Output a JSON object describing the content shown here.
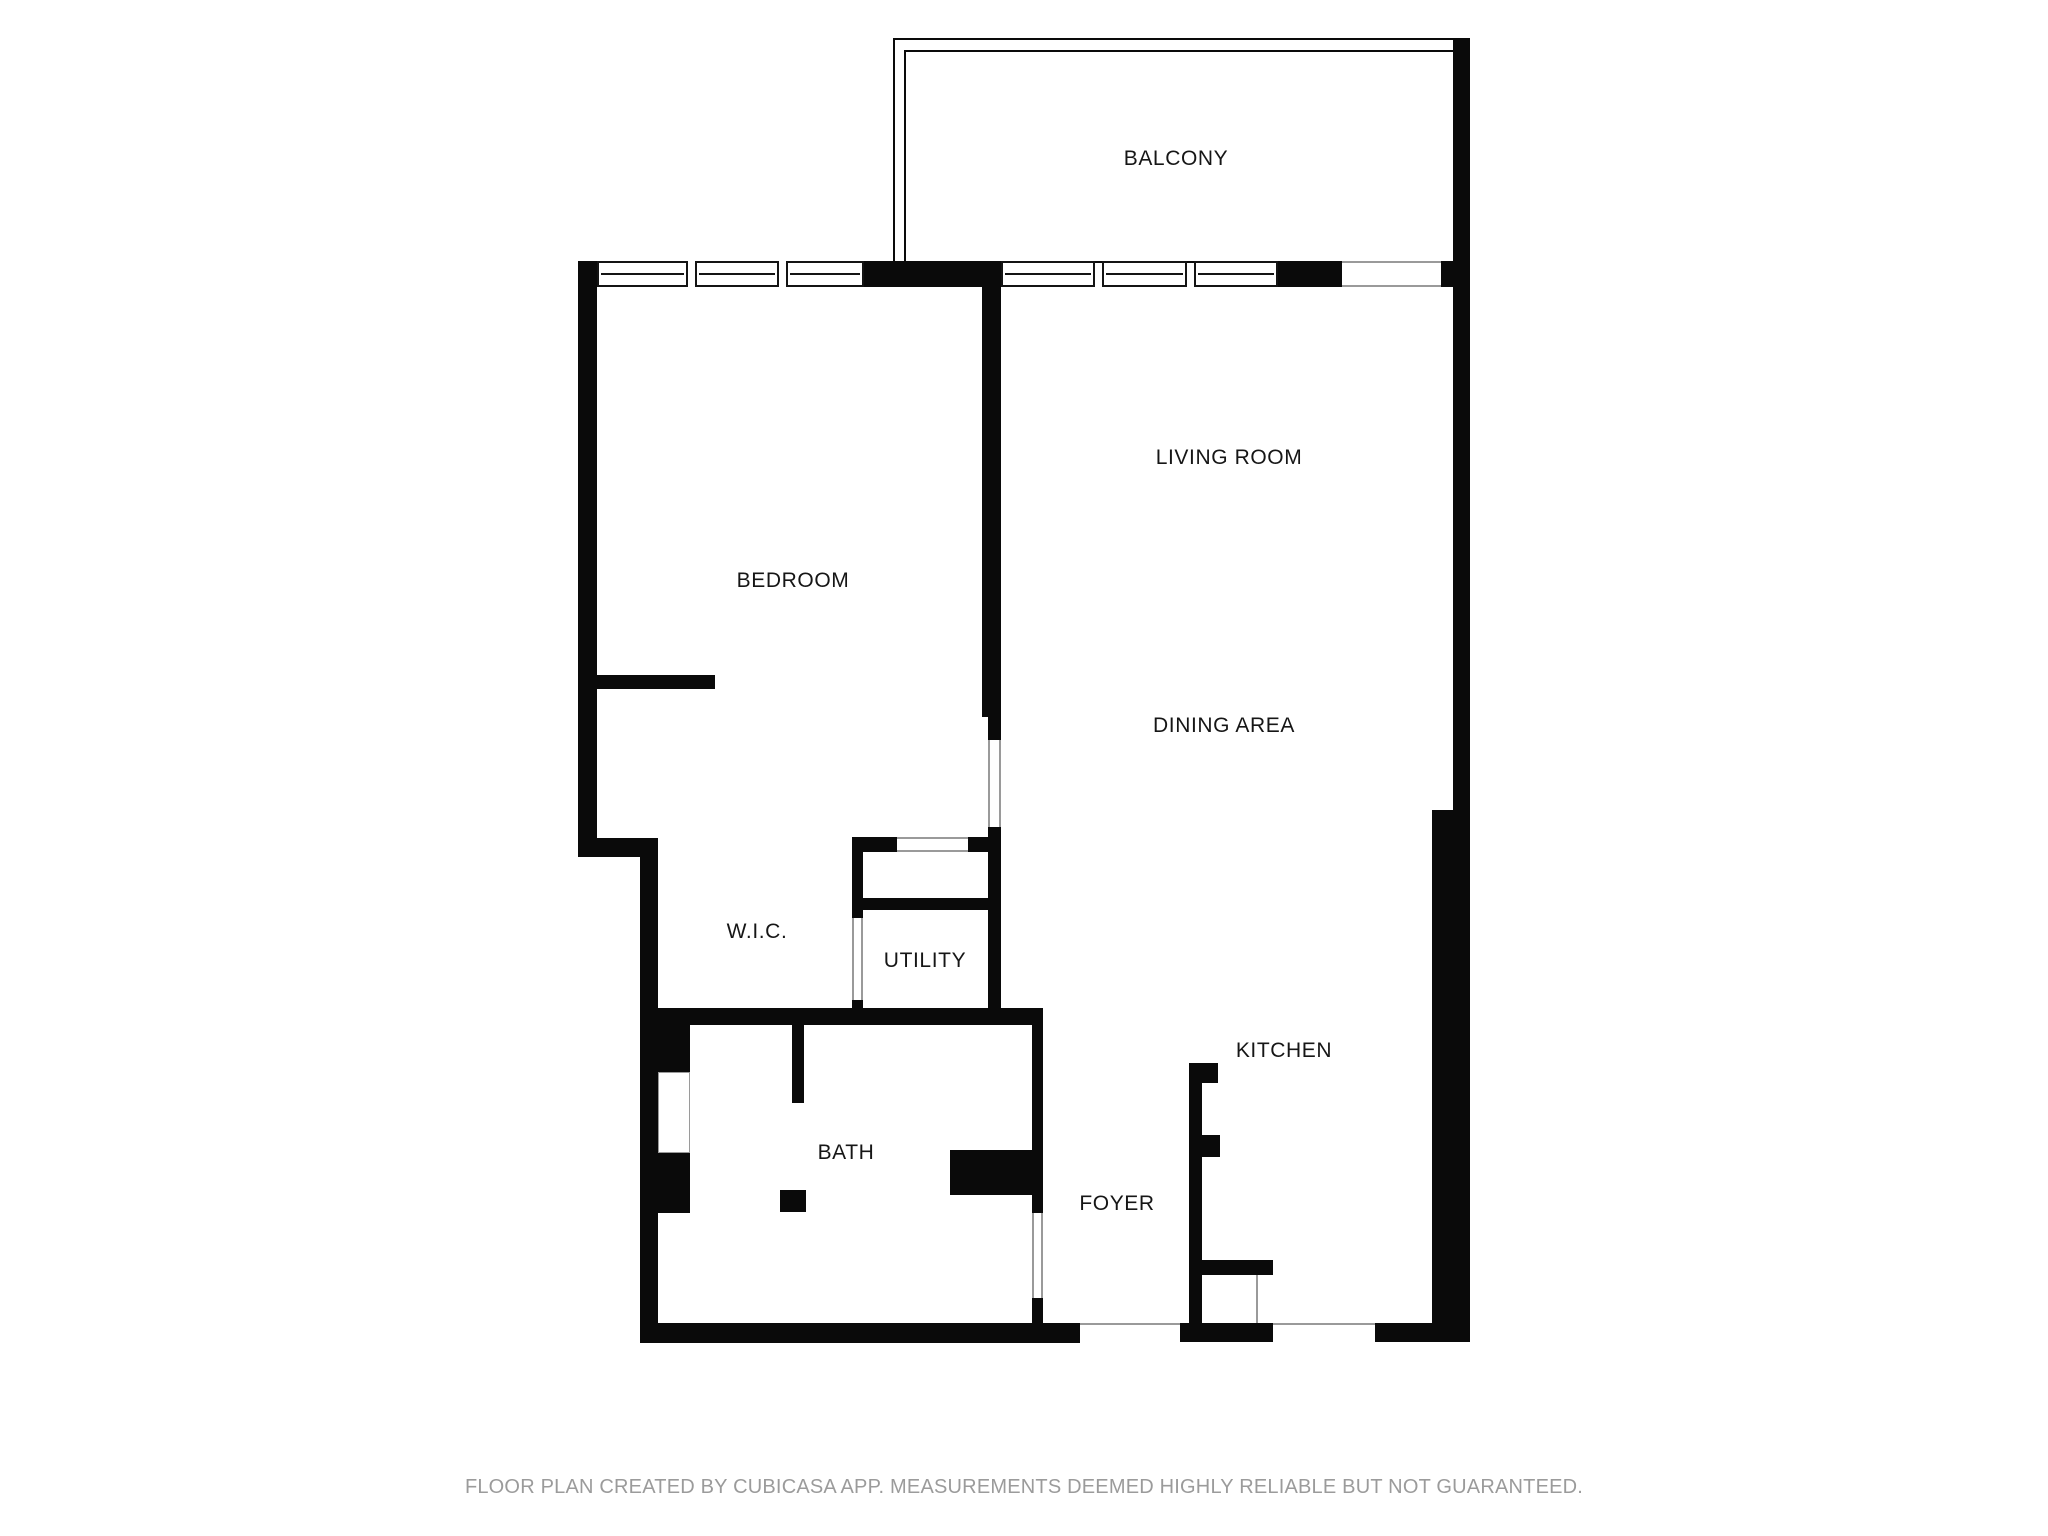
{
  "page": {
    "background": "#ffffff"
  },
  "colors": {
    "wall": "#0a0a0a",
    "window_line": "#141414",
    "opening_edge": "#9a9a9a",
    "label_text": "#161616",
    "footer_text": "#9b9b9b"
  },
  "footer": {
    "text": "FLOOR PLAN CREATED BY CUBICASA APP. MEASUREMENTS DEEMED HIGHLY RELIABLE BUT NOT GUARANTEED."
  },
  "plan": {
    "width": 2048,
    "height": 1536,
    "labels": [
      {
        "id": "balcony",
        "text": "BALCONY",
        "cx": 1176,
        "cy": 159
      },
      {
        "id": "living-room",
        "text": "LIVING ROOM",
        "cx": 1229,
        "cy": 458
      },
      {
        "id": "bedroom",
        "text": "BEDROOM",
        "cx": 793,
        "cy": 581
      },
      {
        "id": "dining-area",
        "text": "DINING AREA",
        "cx": 1224,
        "cy": 726
      },
      {
        "id": "wic",
        "text": "W.I.C.",
        "cx": 757,
        "cy": 932
      },
      {
        "id": "utility",
        "text": "UTILITY",
        "cx": 925,
        "cy": 961
      },
      {
        "id": "bath",
        "text": "BATH",
        "cx": 846,
        "cy": 1153
      },
      {
        "id": "kitchen",
        "text": "KITCHEN",
        "cx": 1284,
        "cy": 1051
      },
      {
        "id": "foyer",
        "text": "FOYER",
        "cx": 1117,
        "cy": 1204
      }
    ],
    "rails": [
      [
        893,
        38,
        577,
        225
      ],
      [
        904,
        50,
        560,
        213
      ]
    ],
    "walls": [
      [
        578,
        261,
        19,
        596
      ],
      [
        578,
        838,
        80,
        19
      ],
      [
        640,
        838,
        18,
        505
      ],
      [
        864,
        261,
        137,
        26
      ],
      [
        982,
        285,
        19,
        432
      ],
      [
        988,
        717,
        13,
        23
      ],
      [
        988,
        827,
        13,
        186
      ],
      [
        852,
        837,
        45,
        15
      ],
      [
        968,
        837,
        33,
        15
      ],
      [
        863,
        898,
        125,
        12
      ],
      [
        852,
        837,
        11,
        81
      ],
      [
        852,
        1000,
        11,
        13
      ],
      [
        657,
        1008,
        386,
        17
      ],
      [
        597,
        675,
        118,
        14
      ],
      [
        658,
        1025,
        32,
        47
      ],
      [
        658,
        1153,
        32,
        60
      ],
      [
        792,
        1025,
        12,
        78
      ],
      [
        780,
        1190,
        26,
        22
      ],
      [
        1032,
        1025,
        11,
        188
      ],
      [
        950,
        1150,
        82,
        45
      ],
      [
        1032,
        1298,
        11,
        25
      ],
      [
        642,
        1323,
        438,
        20
      ],
      [
        1180,
        1323,
        93,
        19
      ],
      [
        1375,
        1323,
        95,
        19
      ],
      [
        1189,
        1063,
        13,
        279
      ],
      [
        1202,
        1063,
        16,
        20
      ],
      [
        1202,
        1135,
        18,
        22
      ],
      [
        1189,
        1260,
        84,
        15
      ],
      [
        1453,
        40,
        17,
        770
      ],
      [
        1432,
        810,
        38,
        532
      ],
      [
        1278,
        261,
        64,
        26
      ],
      [
        1441,
        261,
        12,
        26
      ]
    ],
    "windows": [
      [
        597,
        261,
        91,
        26
      ],
      [
        695,
        261,
        84,
        26
      ],
      [
        786,
        261,
        78,
        26
      ],
      [
        1001,
        261,
        94,
        26
      ],
      [
        1102,
        261,
        85,
        26
      ],
      [
        1194,
        261,
        84,
        26
      ]
    ],
    "openings": [
      {
        "rect": [
          1342,
          261,
          99,
          26
        ],
        "edges": "tb"
      },
      {
        "rect": [
          897,
          837,
          71,
          15
        ],
        "edges": "tb"
      },
      {
        "rect": [
          852,
          918,
          11,
          82
        ],
        "edges": "lr"
      },
      {
        "rect": [
          988,
          740,
          13,
          87
        ],
        "edges": "lr"
      },
      {
        "rect": [
          1032,
          1213,
          11,
          85
        ],
        "edges": "lr"
      },
      {
        "rect": [
          1080,
          1323,
          100,
          4
        ],
        "edges": "t"
      },
      {
        "rect": [
          1273,
          1323,
          102,
          4
        ],
        "edges": "t"
      },
      {
        "rect": [
          658,
          1072,
          32,
          81
        ],
        "edges": "all"
      },
      {
        "rect": [
          1202,
          1275,
          56,
          48
        ],
        "edges": "r"
      }
    ]
  }
}
